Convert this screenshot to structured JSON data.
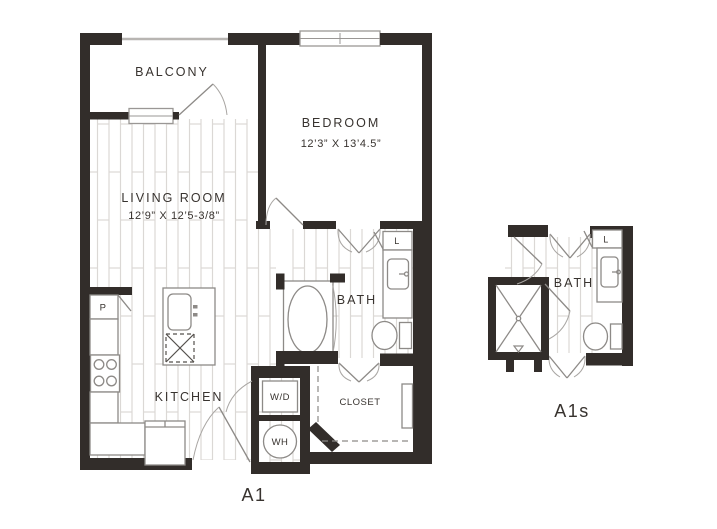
{
  "figure": {
    "type": "apartment-floor-plan",
    "background": "#ffffff"
  },
  "colors": {
    "wall": "#322d2a",
    "label_text": "#38332f",
    "fixture_line": "#8d8a87",
    "floor_plank_line": "#dbd8d5",
    "window_line": "#9a9795"
  },
  "main_plan": {
    "name": "A1",
    "rooms": {
      "balcony": {
        "label": "BALCONY"
      },
      "bedroom": {
        "label": "BEDROOM",
        "dimensions": "12’3” X 13’4.5”"
      },
      "living_room": {
        "label": "LIVING ROOM",
        "dimensions": "12’9” X 12’5-3/8”"
      },
      "kitchen": {
        "label": "KITCHEN"
      },
      "bath": {
        "label": "BATH"
      },
      "closet": {
        "label": "CLOSET"
      }
    },
    "fixtures": {
      "pantry": {
        "label": "P"
      },
      "linen": {
        "label": "L"
      },
      "washer_dryer": {
        "label": "W/D"
      },
      "water_heater": {
        "label": "WH"
      }
    }
  },
  "small_plan": {
    "name": "A1s",
    "rooms": {
      "bath": {
        "label": "BATH"
      }
    },
    "fixtures": {
      "linen": {
        "label": "L"
      }
    }
  }
}
